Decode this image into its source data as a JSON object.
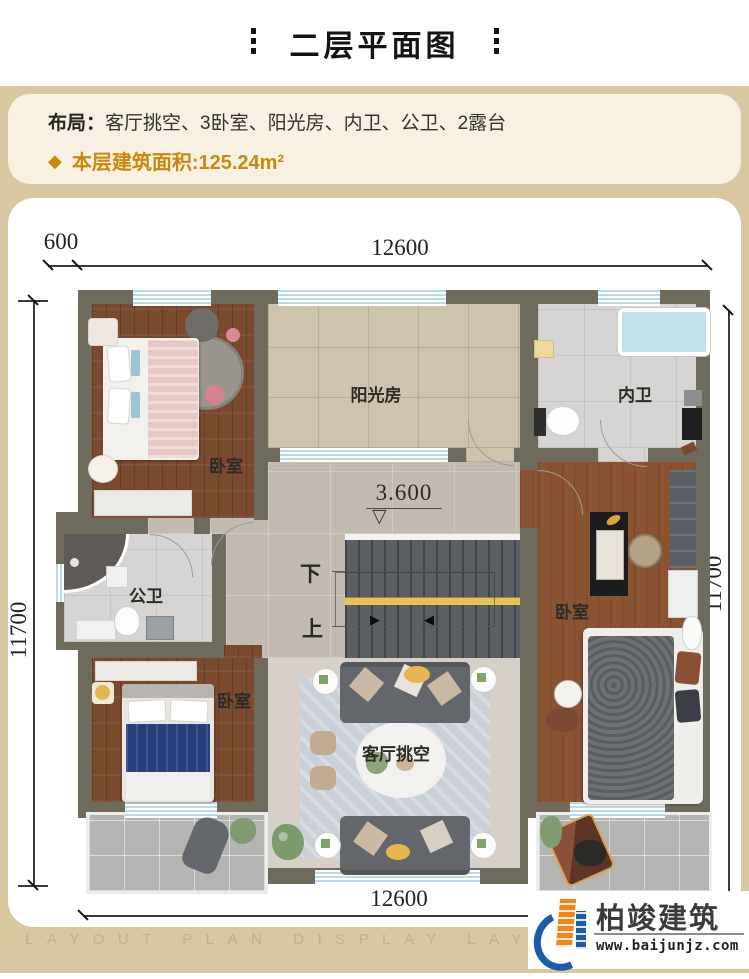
{
  "title": "二层平面图",
  "info": {
    "layout_label": "布局：",
    "layout_value": "客厅挑空、3卧室、阳光房、内卫、公卫、2露台",
    "area_text": "本层建筑面积:125.24m²",
    "accent_color": "#c9880e"
  },
  "dimensions": {
    "top_offset": "600",
    "top_width": "12600",
    "left_height": "11700",
    "right_height": "11700",
    "bottom_width": "12600"
  },
  "plan": {
    "elevation": "3.600",
    "stair_down": "下",
    "stair_up": "上",
    "rooms": {
      "bedroom_top_left": "卧室",
      "sunroom": "阳光房",
      "inner_bath": "内卫",
      "public_bath": "公卫",
      "bedroom_right": "卧室",
      "bedroom_bottom_left": "卧室",
      "living_void": "客厅挑空"
    },
    "wall_color": "#6e6a5c"
  },
  "icons": {
    "diamond": "◆",
    "elevation_marker": "▽",
    "stair_arrow_right": "▶",
    "stair_arrow_left": "◀"
  },
  "footer": {
    "watermark": "LAYOUT PLAN DISPLAY LAYOUT PLAN DISPLAY",
    "logo_name": "柏竣建筑",
    "logo_url": "www.baijunjz.com"
  }
}
